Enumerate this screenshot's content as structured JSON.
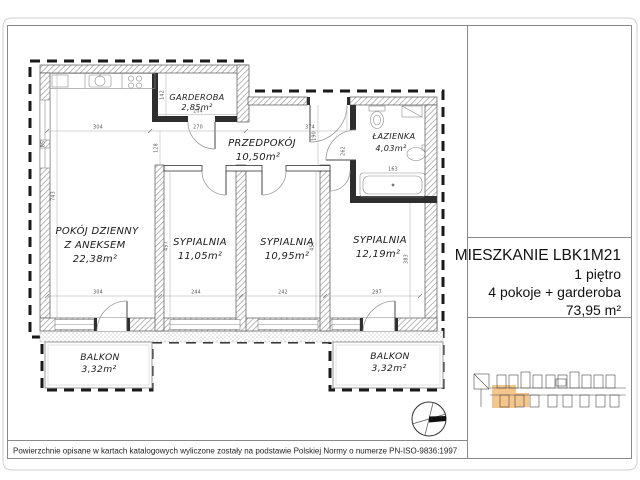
{
  "colors": {
    "highlight": "#f4c68c",
    "wall_line": "#555555",
    "dash_boundary": "#1a1a1a"
  },
  "plan": {
    "rooms": {
      "garderoba": {
        "name": "GARDEROBA",
        "area": "2,85m²"
      },
      "przedpokoj": {
        "name": "PRZEDPOKÓJ",
        "area": "10,50m²"
      },
      "lazienka": {
        "name": "ŁAZIENKA",
        "area": "4,03m²"
      },
      "pokoj_dzienny": {
        "name": "POKÓJ DZIENNY",
        "name2": "Z ANEKSEM",
        "area": "22,38m²"
      },
      "sypialnia1": {
        "name": "SYPIALNIA",
        "area": "11,05m²"
      },
      "sypialnia2": {
        "name": "SYPIALNIA",
        "area": "10,95m²"
      },
      "sypialnia3": {
        "name": "SYPIALNIA",
        "area": "12,19m²"
      },
      "balkon1": {
        "name": "BALKON",
        "area": "3,32m²"
      },
      "balkon2": {
        "name": "BALKON",
        "area": "3,32m²"
      }
    },
    "dimensions": {
      "kitchen_w": "304",
      "opening": "270",
      "garderoba_w": "204",
      "garderoba_h": "142",
      "passage": "128",
      "hall_w": "374",
      "hall_h": "190",
      "left_wall": "743",
      "left_seg": "85",
      "wall_h": "457",
      "syp3_h": "383",
      "bath_h": "262",
      "tub_w": "163",
      "living_w": "304",
      "syp1_w": "244",
      "syp2_w": "242",
      "syp3_w": "297"
    }
  },
  "info_panel": {
    "title": "MIESZKANIE LBK1M21",
    "floor": "1 piętro",
    "rooms_desc": "4 pokoje + garderoba",
    "total_area": "73,95 m²"
  },
  "footer": {
    "note": "Powierzchnie opisane w kartach katalogowych wyliczone zostały na podstawie Polskiej Normy o numerze PN-ISO-9836:1997"
  }
}
